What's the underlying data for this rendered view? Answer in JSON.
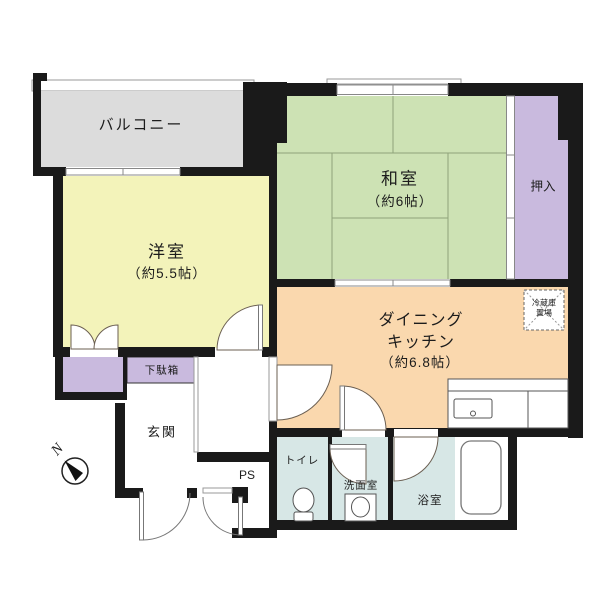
{
  "plan": {
    "labels": {
      "balcony": "バルコニー",
      "japanese_room": "和室",
      "japanese_room_size": "（約6帖）",
      "oshiire": "押入",
      "western_room": "洋室",
      "western_room_size": "（約5.5帖）",
      "dk_line1": "ダイニング",
      "dk_line2": "キッチン",
      "dk_size": "（約6.8帖）",
      "fridge_line1": "冷蔵庫",
      "fridge_line2": "置場",
      "shoe_cabinet": "下駄箱",
      "entrance": "玄関",
      "pipe_space": "PS",
      "toilet": "トイレ",
      "washroom": "洗面室",
      "bathroom": "浴室",
      "north": "N"
    },
    "colors": {
      "wall": "#1a1a1a",
      "balcony": "#dcdcdc",
      "japanese_room": "#cde2b4",
      "oshiire": "#c9bade",
      "western_room": "#f3f3ba",
      "dining_kitchen": "#fad8ae",
      "wet_room": "#d7e7e6",
      "closet": "#c9bade",
      "shoe_cabinet": "#c9bade",
      "tatami_line": "#8ea37a"
    }
  }
}
